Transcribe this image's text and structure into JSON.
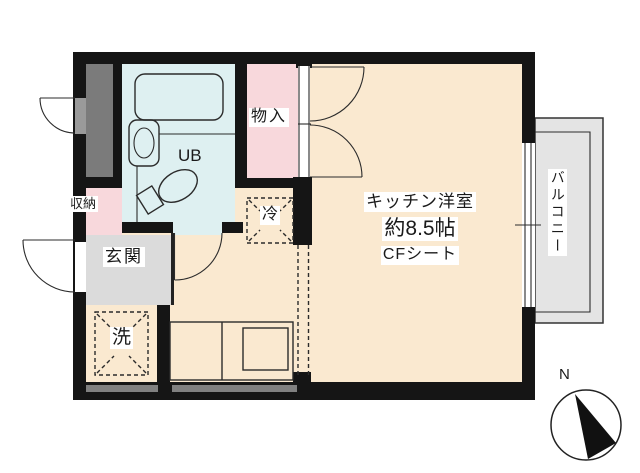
{
  "floor_plan": {
    "rooms": {
      "main_room": {
        "name": "キッチン洋室",
        "size": "約8.5帖",
        "flooring": "CFシート"
      },
      "unit_bath": {
        "label": "UB"
      },
      "closet": {
        "label": "物入"
      },
      "storage": {
        "label": "収納"
      },
      "entrance": {
        "label": "玄関"
      },
      "laundry": {
        "label": "洗"
      },
      "refrigerator": {
        "label": "冷"
      },
      "balcony": {
        "label": "バルコニー"
      }
    },
    "compass": {
      "north_label": "N"
    },
    "colors": {
      "wall": "#151515",
      "room_floor": "#FAE9D0",
      "wet_area": "#DEF0F1",
      "closet_pink": "#F8D8DC",
      "entrance_gray": "#DBDBDB",
      "shaft_gray": "#7B7B7B",
      "balcony_gray": "#E4E4E4",
      "wall_inset_gray": "#808080"
    }
  }
}
